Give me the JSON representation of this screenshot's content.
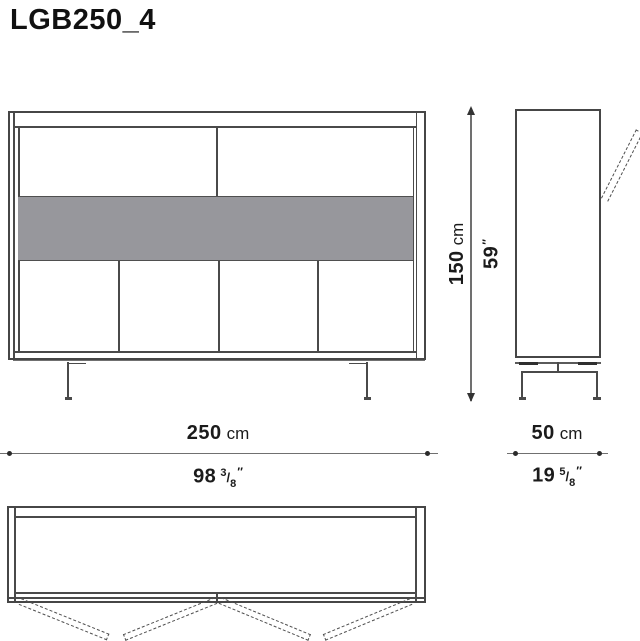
{
  "title": "LGB250_4",
  "colors": {
    "line": "#4a4a4a",
    "dim_line": "#707070",
    "shelf_fill": "#97979c",
    "text": "#1b1b1b"
  },
  "dimensions": {
    "width": {
      "cm_value": "250",
      "cm_unit": "cm",
      "in_value": "98",
      "frac_num": "3",
      "frac_sep": "/",
      "frac_den": "8",
      "inch_mark": "″"
    },
    "depth": {
      "cm_value": "50",
      "cm_unit": "cm",
      "in_value": "19",
      "frac_num": "5",
      "frac_sep": "/",
      "frac_den": "8",
      "inch_mark": "″"
    },
    "height": {
      "cm_value": "150",
      "cm_unit": "cm",
      "in_value": "59",
      "inch_mark": "″"
    }
  }
}
